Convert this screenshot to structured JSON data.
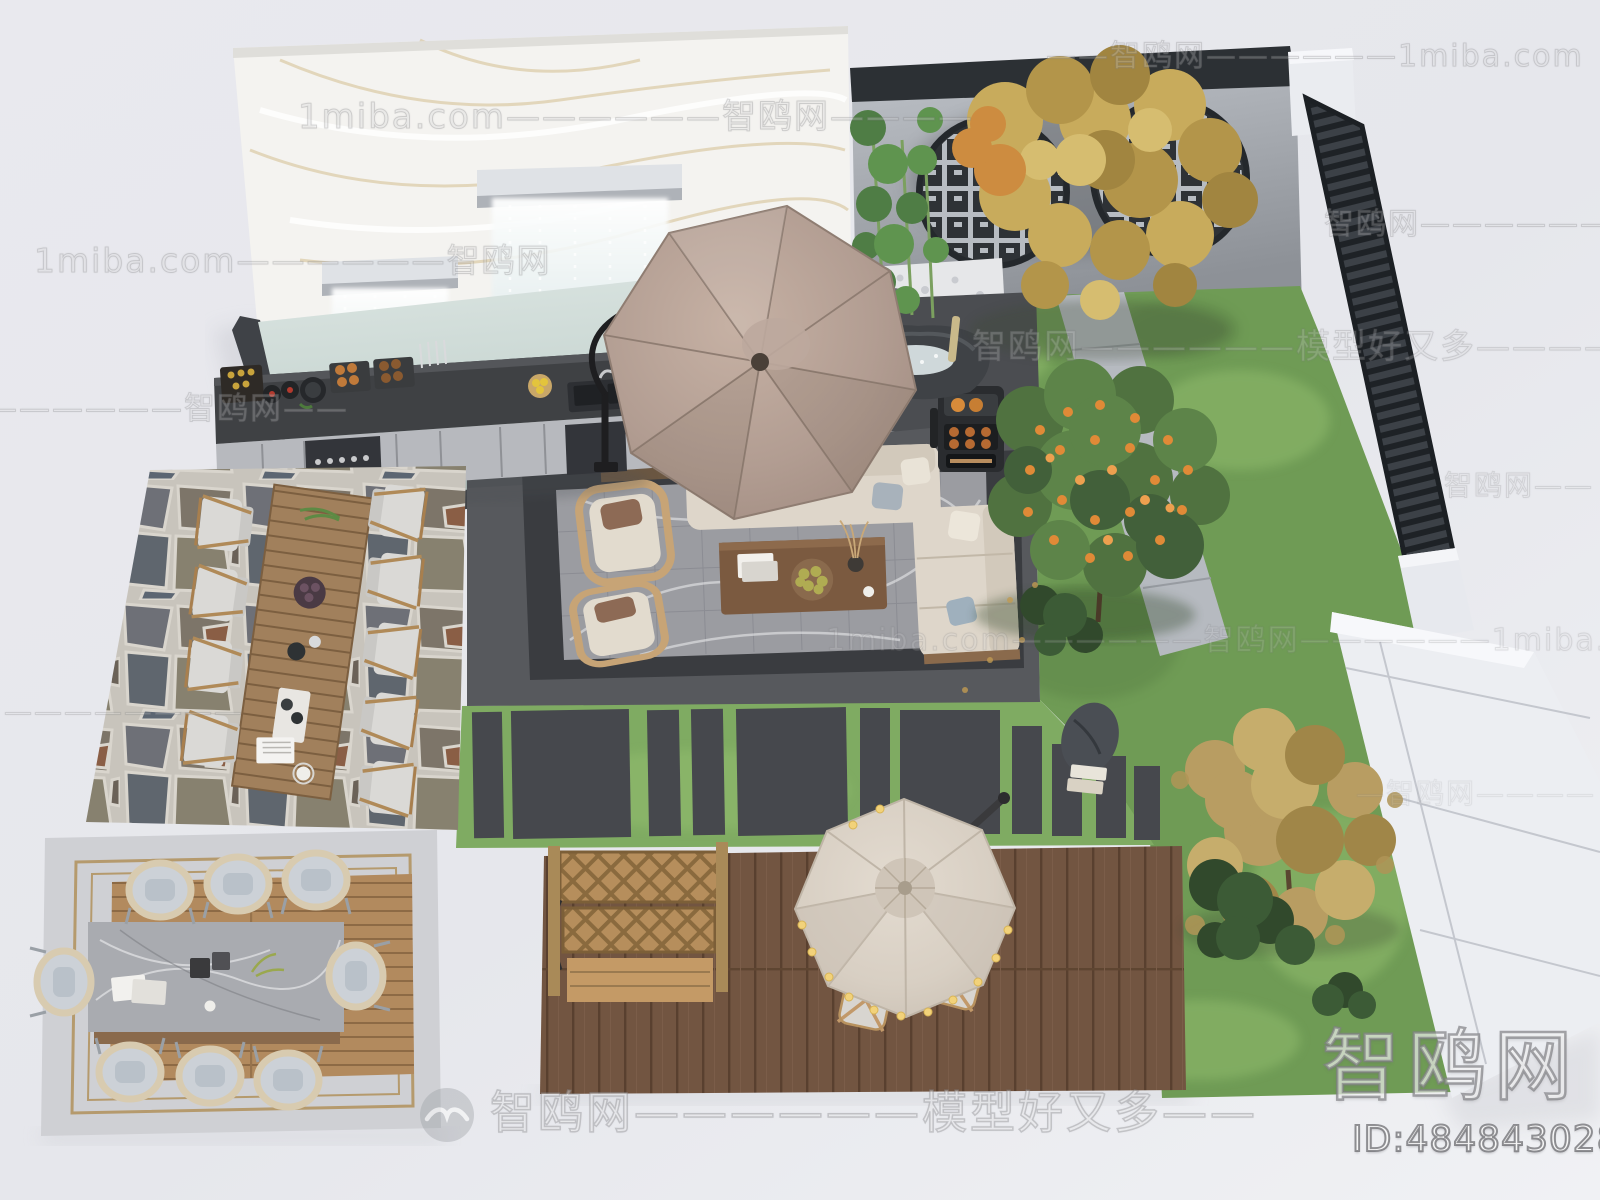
{
  "image": {
    "kind": "3D aerial render of a modern courtyard garden landscape",
    "width": 1600,
    "height": 1200
  },
  "branding": {
    "watermark_site": "智鸥网",
    "watermark_domain": "1miba.com",
    "watermark_slogan": "模型好又多",
    "logo_text": "智鸥网",
    "id_label": "ID:484843028",
    "bird_icon": "seagull-in-circle"
  },
  "watermarks": {
    "rows": [
      {
        "id": "r1",
        "text": "——智鸥网——————1miba.com"
      },
      {
        "id": "r2",
        "text": "1miba.com——————智鸥网————"
      },
      {
        "id": "r3",
        "text": "智鸥网———————"
      },
      {
        "id": "r4",
        "text": "1miba.com——————智鸥网"
      },
      {
        "id": "r5",
        "text": "智鸥网——————模型好又多————"
      },
      {
        "id": "r6",
        "text": "——————智鸥网——"
      },
      {
        "id": "r7",
        "text": "1miba.com——————智鸥网——————1miba.com"
      },
      {
        "id": "r8",
        "text": "————————"
      },
      {
        "id": "r9",
        "text": "智鸥网——"
      },
      {
        "id": "r10",
        "text": "—智鸥网————"
      },
      {
        "id": "r11",
        "text": "智鸥网——————模型好又多——"
      }
    ]
  },
  "palette": {
    "background": "#e9e9ee",
    "marble_wall": "#f3f2ef",
    "pool_water": "#ccd9d5",
    "patio_dark": "#57595d",
    "rug_marble": "#9b9ca1",
    "grass": "#6f9b55",
    "deck_wood": "#7a5a46",
    "flagstone_mortar": "#c8c4bc",
    "umbrella_taupe": "#b29d92",
    "umbrella_cream": "#d8cfc3",
    "sofa_cream": "#ded6ca",
    "fence_slat": "#363b41",
    "garden_wall_gray": "#b0b4ba",
    "white_wall": "#eceef2",
    "autumn_foliage": "#c2a866",
    "orange_fruit": "#e08a37"
  },
  "scene_labels": {
    "areas": [
      "marble waterfall wall",
      "reflecting pool",
      "outdoor kitchen with grills",
      "flagstone dining patio",
      "long timber dining table",
      "central lounge with cantilever umbrella",
      "marble area rug lounge",
      "stone water-bowl table",
      "charcoal smoker grill",
      "lattice moon-window wall",
      "bamboo planting",
      "golden autumn tree",
      "orange fruit tree",
      "slatted privacy fence",
      "white stone boundary wall",
      "stepping-stone lawn band",
      "timber deck with string-light umbrella",
      "lattice wood bench",
      "terrazzo dining platform"
    ]
  }
}
